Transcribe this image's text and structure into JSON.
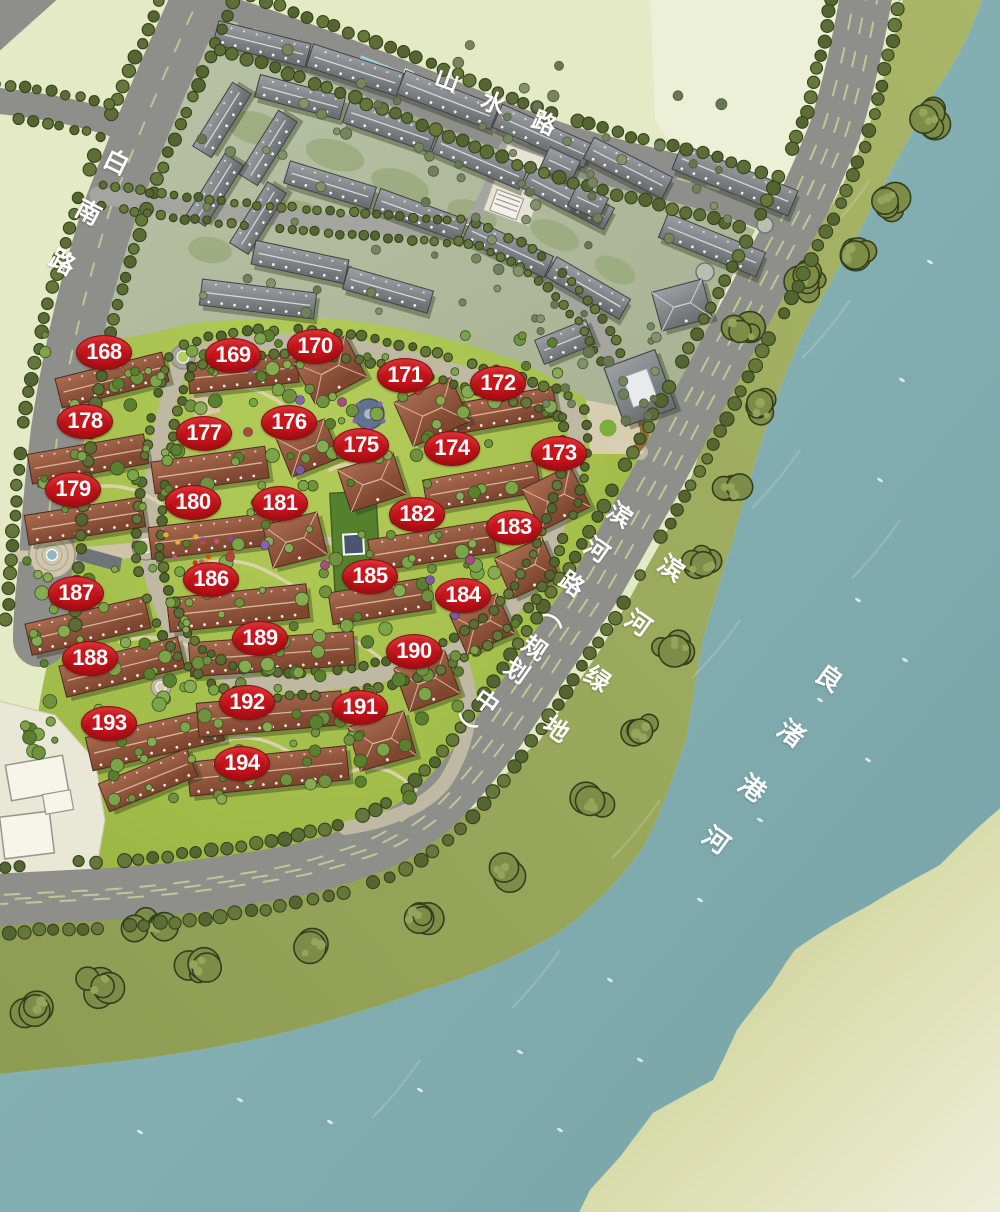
{
  "map": {
    "type": "residential-master-plan",
    "roads": [
      {
        "id": "shanshui",
        "name": "山水路",
        "chars": [
          {
            "t": "山",
            "x": 448,
            "y": 78,
            "r": 20
          },
          {
            "t": "水",
            "x": 494,
            "y": 101,
            "r": 22
          },
          {
            "t": "路",
            "x": 545,
            "y": 121,
            "r": 23
          }
        ]
      },
      {
        "id": "bainan",
        "name": "白南路",
        "chars": [
          {
            "t": "白",
            "x": 117,
            "y": 161,
            "r": 26
          },
          {
            "t": "南",
            "x": 89,
            "y": 211,
            "r": 28
          },
          {
            "t": "路",
            "x": 63,
            "y": 261,
            "r": 28
          }
        ]
      },
      {
        "id": "binhe",
        "name": "滨河路（规划中）",
        "chars": [
          {
            "t": "滨",
            "x": 621,
            "y": 513,
            "r": 35
          },
          {
            "t": "河",
            "x": 598,
            "y": 548,
            "r": 35
          },
          {
            "t": "路",
            "x": 573,
            "y": 582,
            "r": 35
          },
          {
            "t": "（",
            "x": 559,
            "y": 614,
            "r": 125
          },
          {
            "t": "规",
            "x": 536,
            "y": 646,
            "r": 35
          },
          {
            "t": "划",
            "x": 518,
            "y": 669,
            "r": 35
          },
          {
            "t": "中",
            "x": 488,
            "y": 700,
            "r": 35
          },
          {
            "t": "）",
            "x": 464,
            "y": 729,
            "r": 125
          }
        ]
      }
    ],
    "areas": [
      {
        "id": "greenbelt",
        "name": "滨河绿地",
        "chars": [
          {
            "t": "滨",
            "x": 672,
            "y": 567,
            "r": 35
          },
          {
            "t": "河",
            "x": 639,
            "y": 622,
            "r": 35
          },
          {
            "t": "绿",
            "x": 598,
            "y": 678,
            "r": 35
          },
          {
            "t": "地",
            "x": 557,
            "y": 728,
            "r": 35
          }
        ]
      },
      {
        "id": "river",
        "name": "良渚港河",
        "chars": [
          {
            "t": "良",
            "x": 830,
            "y": 677,
            "r": 36
          },
          {
            "t": "渚",
            "x": 792,
            "y": 732,
            "r": 36
          },
          {
            "t": "港",
            "x": 753,
            "y": 787,
            "r": 36
          },
          {
            "t": "河",
            "x": 717,
            "y": 839,
            "r": 36
          }
        ]
      }
    ],
    "building_labels": [
      {
        "num": "168",
        "x": 103,
        "y": 351
      },
      {
        "num": "169",
        "x": 232,
        "y": 354
      },
      {
        "num": "170",
        "x": 314,
        "y": 345
      },
      {
        "num": "171",
        "x": 404,
        "y": 374
      },
      {
        "num": "172",
        "x": 497,
        "y": 382
      },
      {
        "num": "178",
        "x": 84,
        "y": 420
      },
      {
        "num": "177",
        "x": 203,
        "y": 432
      },
      {
        "num": "176",
        "x": 288,
        "y": 421
      },
      {
        "num": "175",
        "x": 360,
        "y": 444
      },
      {
        "num": "174",
        "x": 451,
        "y": 447
      },
      {
        "num": "173",
        "x": 558,
        "y": 452
      },
      {
        "num": "179",
        "x": 72,
        "y": 488
      },
      {
        "num": "180",
        "x": 192,
        "y": 501
      },
      {
        "num": "181",
        "x": 279,
        "y": 502
      },
      {
        "num": "182",
        "x": 416,
        "y": 513
      },
      {
        "num": "183",
        "x": 513,
        "y": 526
      },
      {
        "num": "187",
        "x": 75,
        "y": 592
      },
      {
        "num": "186",
        "x": 210,
        "y": 578
      },
      {
        "num": "185",
        "x": 369,
        "y": 575
      },
      {
        "num": "184",
        "x": 462,
        "y": 594
      },
      {
        "num": "188",
        "x": 89,
        "y": 657
      },
      {
        "num": "189",
        "x": 259,
        "y": 637
      },
      {
        "num": "190",
        "x": 413,
        "y": 650
      },
      {
        "num": "193",
        "x": 108,
        "y": 722
      },
      {
        "num": "192",
        "x": 246,
        "y": 701
      },
      {
        "num": "191",
        "x": 359,
        "y": 706
      },
      {
        "num": "194",
        "x": 241,
        "y": 762
      }
    ],
    "palette": {
      "badge_red": "#c9151c",
      "badge_text": "#ffffff",
      "label_white": "#ffffff",
      "road_asphalt": "#8e8e8a",
      "road_internal": "#a5a5a0",
      "loop_road": "#bfb8a2",
      "river_teal": "#86b0b4",
      "river_deep": "#76a3a8",
      "greenbelt_olive": "#9aa95e",
      "bank_cream": "#ecedd6",
      "site_green": "#a8c24c",
      "gray_zone": "#b4bda0",
      "gray_roof": "#7e8184",
      "red_roof": "#91563f",
      "pale_field": "#e4e9c6",
      "street_tree": "#5d6d37",
      "lawn": "#c9dc77",
      "canal_blue": "#a3ccd9"
    }
  }
}
